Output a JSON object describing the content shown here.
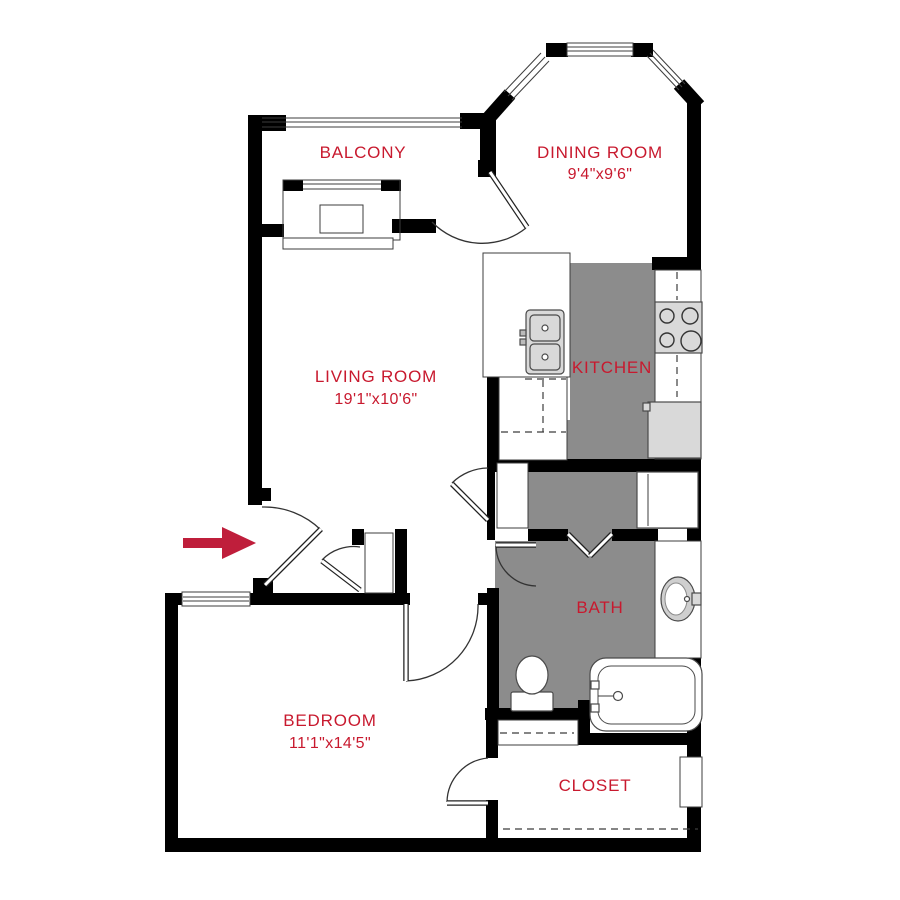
{
  "plan": {
    "title": "One-bedroom apartment floor plan",
    "rooms": [
      {
        "name": "BALCONY",
        "dims": ""
      },
      {
        "name": "DINING ROOM",
        "dims": "9'4\"x9'6\""
      },
      {
        "name": "LIVING ROOM",
        "dims": "19'1\"x10'6\""
      },
      {
        "name": "KITCHEN",
        "dims": ""
      },
      {
        "name": "BATH",
        "dims": ""
      },
      {
        "name": "BEDROOM",
        "dims": "11'1\"x14'5\""
      },
      {
        "name": "CLOSET",
        "dims": ""
      }
    ],
    "fixtures": [
      "entry-arrow",
      "balcony-sliding-door",
      "bay-windows",
      "kitchen-double-sink",
      "stove-4-burner",
      "refrigerator",
      "washer-dryer",
      "bifold-doors",
      "bathroom-vanity-sink",
      "toilet",
      "bathtub",
      "bedroom-window",
      "closet-shelf"
    ],
    "colors": {
      "label": "#c8192e",
      "arrow": "#bf1e3b",
      "floor_gray": "#8c8c8c",
      "appliance_gray": "#d9d9d9",
      "wall": "#000000"
    }
  }
}
